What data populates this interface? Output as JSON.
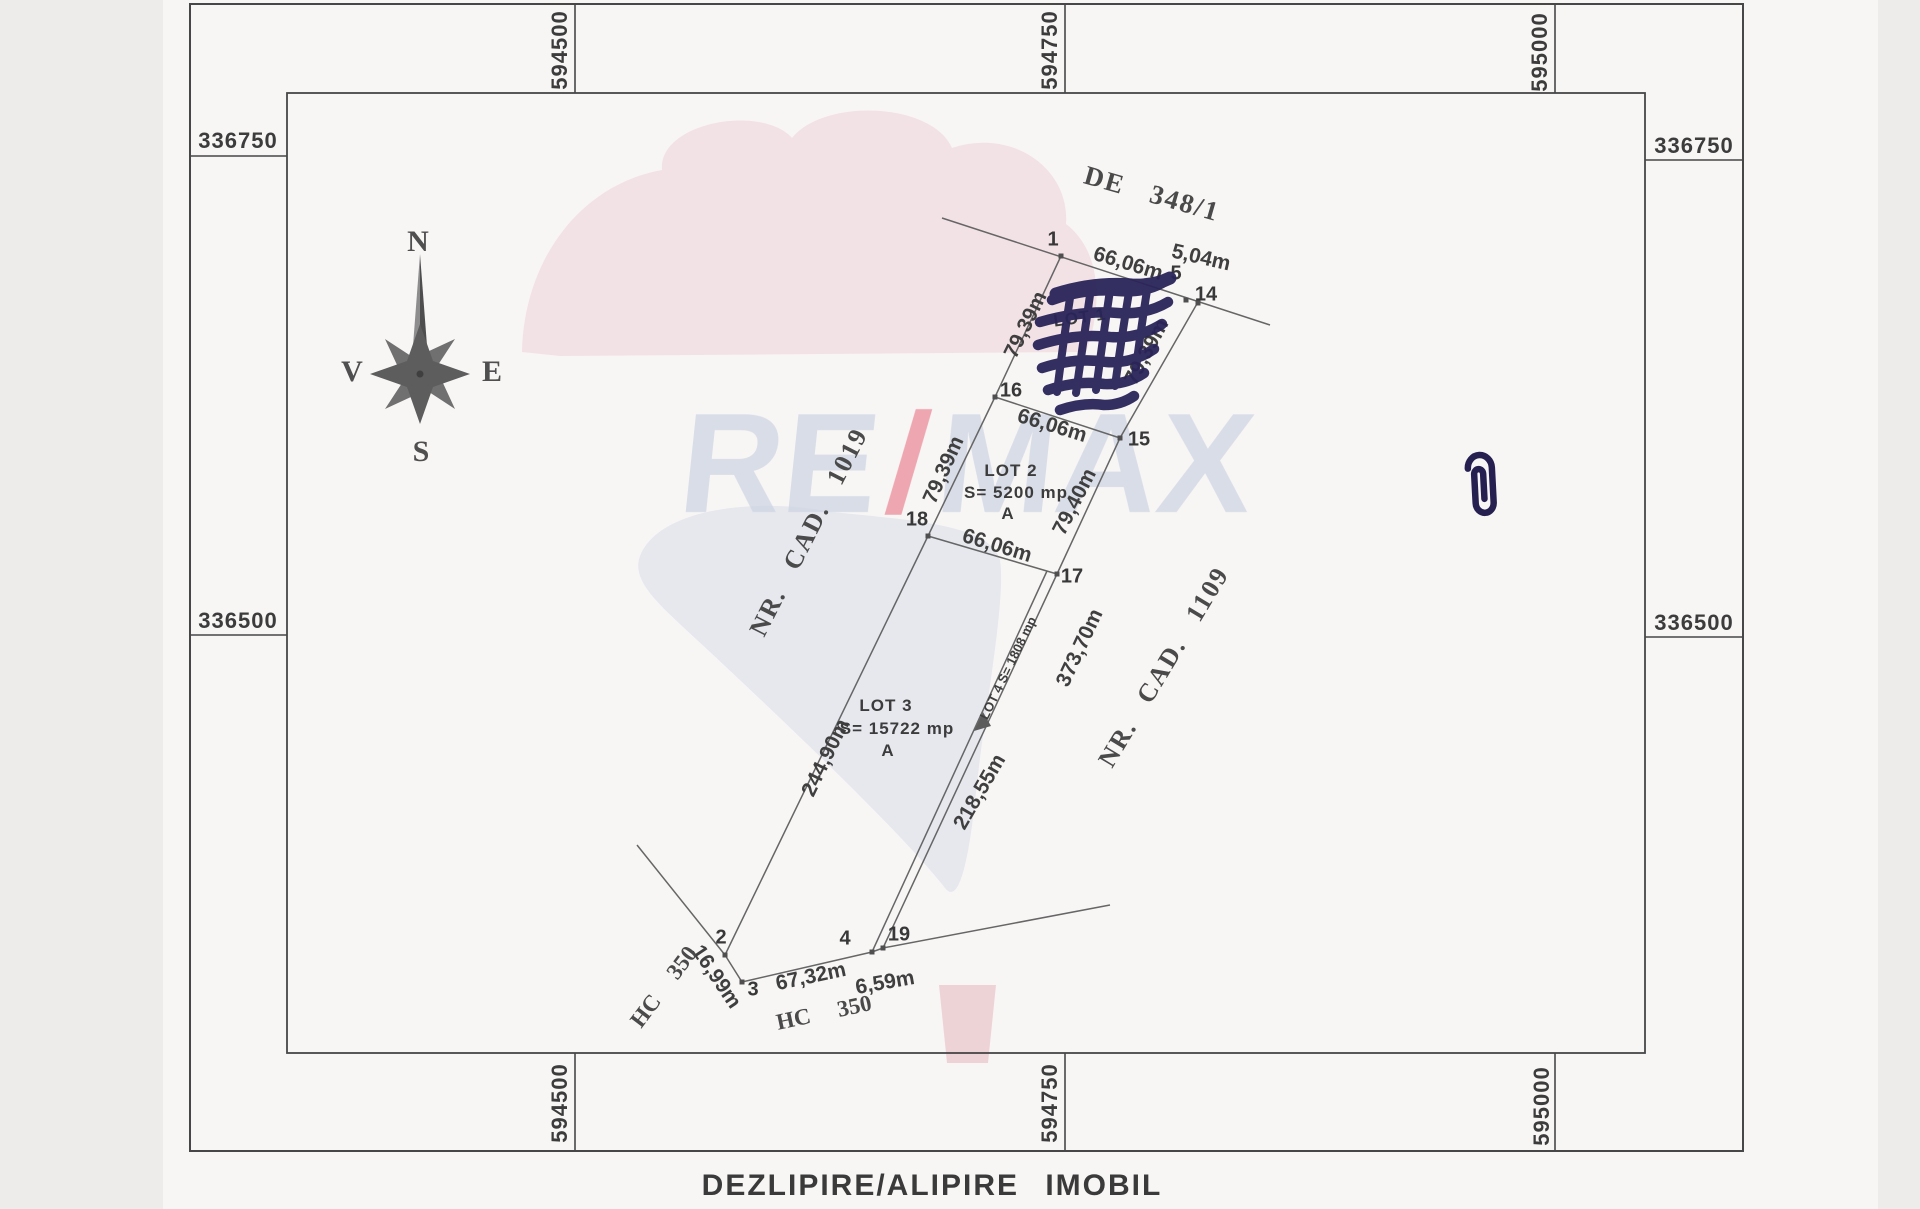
{
  "page": {
    "title": "DEZLIPIRE/ALIPIRE IMOBIL"
  },
  "compass": {
    "north": "N",
    "south": "S",
    "east": "E",
    "west": "V"
  },
  "grid": {
    "top": [
      "594500",
      "594750",
      "595000"
    ],
    "bottom": [
      "594500",
      "594750",
      "595000"
    ],
    "left": [
      "336750",
      "336500"
    ],
    "right": [
      "336750",
      "336500"
    ]
  },
  "road": {
    "label": "DE 348/1",
    "length_1_5": "66,06m",
    "length_5_14": "5,04m"
  },
  "cadastral": {
    "west": "NR. CAD. 1019",
    "east": "NR. CAD. 1109"
  },
  "points": {
    "p1": "1",
    "p2": "2",
    "p3": "3",
    "p4": "4",
    "p5": "5",
    "p14": "14",
    "p15": "15",
    "p16": "16",
    "p17": "17",
    "p18": "18",
    "p19": "19"
  },
  "lot1": {
    "name": "LOT 1",
    "west": "79,39m",
    "east": "79,39m",
    "south": "66,06m"
  },
  "lot2": {
    "name": "LOT 2",
    "area": "S= 5200 mp",
    "note": "A",
    "west": "79,39m",
    "east": "79,40m",
    "south": "66,06m"
  },
  "lot3": {
    "name": "LOT 3",
    "area": "S= 15722 mp",
    "note": "A",
    "west": "244,90m",
    "east": "218,55m"
  },
  "lot4": {
    "label": "LOT 4 S= 1808 mp",
    "east": "373,70m"
  },
  "south_boundary": {
    "seg_2_3": "16,99m",
    "seg_3_4": "67,32m",
    "seg_4_19": "6,59m",
    "hc_west": "HC 350",
    "hc_south": "HC 350"
  },
  "watermark": {
    "re": "RE",
    "slash": "/",
    "max": "MAX",
    "pink": "#eccdd5",
    "blue": "#d6dcea",
    "letter": "#c8d0e1",
    "slash_color": "#e8808f",
    "ink": "#2a2459"
  }
}
